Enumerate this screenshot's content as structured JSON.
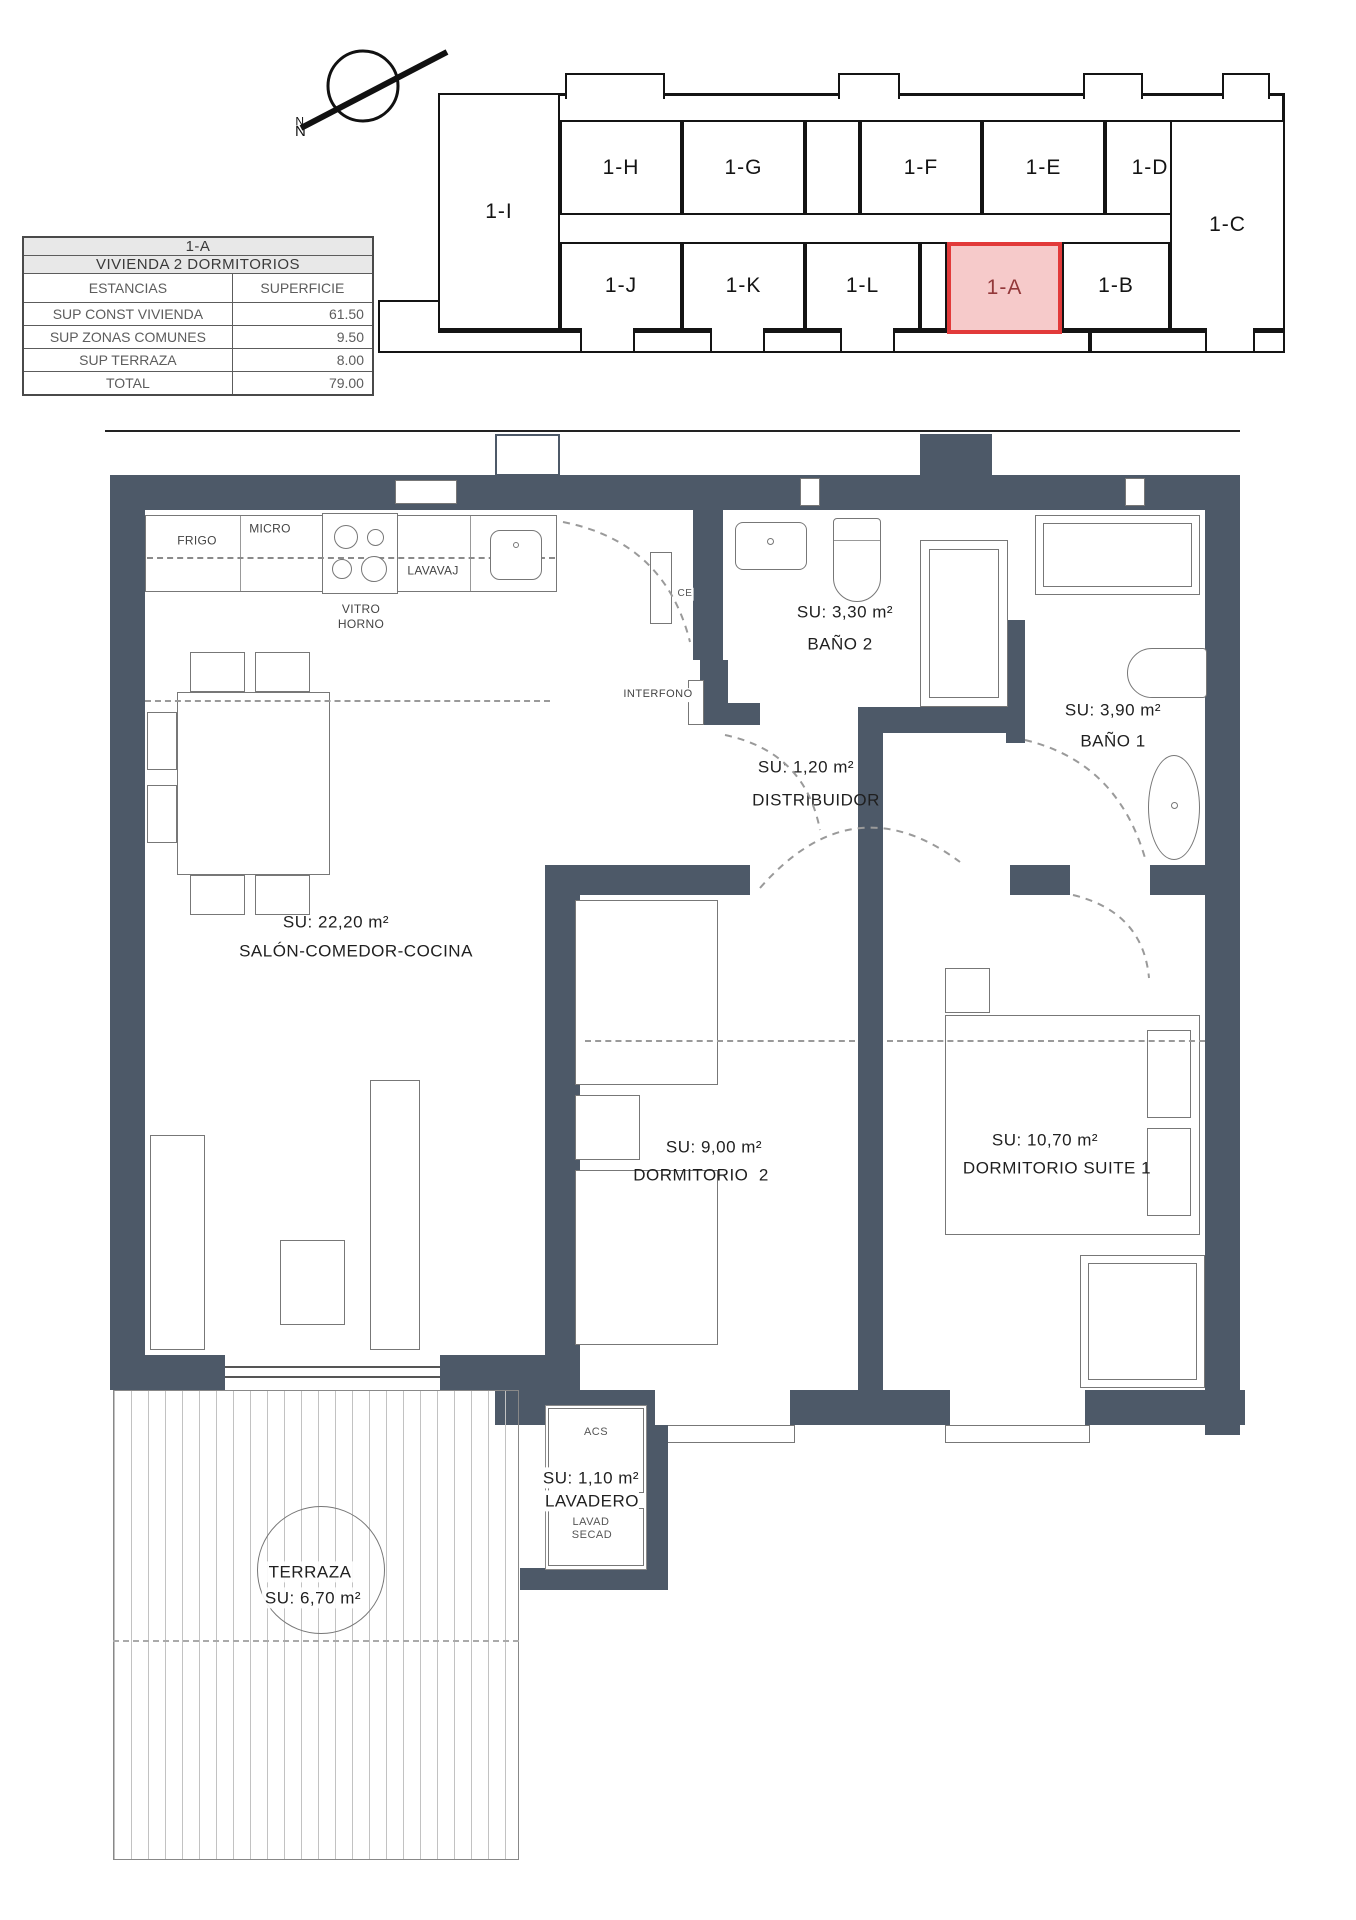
{
  "north": {
    "label": "N"
  },
  "key_plan": {
    "unit_left": "1-I",
    "unit_right": "1-C",
    "units_top": [
      "1-H",
      "1-G",
      "1-F",
      "1-E",
      "1-D"
    ],
    "units_bottom": [
      "1-J",
      "1-K",
      "1-L",
      "1-A",
      "1-B"
    ],
    "highlighted_unit": "1-A",
    "highlight_border": "#e23a3a",
    "highlight_fill": "#f6caca"
  },
  "info_table": {
    "title": "1-A",
    "subtitle": "VIVIENDA 2 DORMITORIOS",
    "col_estancias": "ESTANCIAS",
    "col_superficie": "SUPERFICIE",
    "rows": [
      {
        "label": "SUP CONST VIVIENDA",
        "value": "61.50"
      },
      {
        "label": "SUP ZONAS COMUNES",
        "value": "9.50"
      },
      {
        "label": "SUP TERRAZA",
        "value": "8.00"
      },
      {
        "label": "TOTAL",
        "value": "79.00"
      }
    ]
  },
  "plan": {
    "wall_color": "#4d5968",
    "rooms": {
      "salon": {
        "su": "SU: 22,20 m²",
        "name": "SALÓN-COMEDOR-COCINA"
      },
      "bano2": {
        "su": "SU: 3,30 m²",
        "name": "BAÑO 2"
      },
      "bano1": {
        "su": "SU: 3,90 m²",
        "name": "BAÑO 1"
      },
      "distribuidor": {
        "su": "SU: 1,20 m²",
        "name": "DISTRIBUIDOR"
      },
      "dormitorio2": {
        "su": "SU: 9,00 m²",
        "name": "DORMITORIO  2"
      },
      "suite": {
        "su": "SU: 10,70 m²",
        "name": "DORMITORIO SUITE 1"
      },
      "terraza": {
        "name": "TERRAZA",
        "su": "SU: 6,70 m²"
      },
      "lavadero": {
        "su": "SU: 1,10 m²",
        "name": "LAVADERO",
        "acs": "ACS",
        "lavad": "LAVAD",
        "secad": "SECAD"
      }
    },
    "kitchen": {
      "frigo": "FRIGO",
      "micro": "MICRO",
      "lavavaj": "LAVAVAJ",
      "vitro_horno": "VITRO\nHORNO"
    },
    "annotations": {
      "interfono": "INTERFONO",
      "ce": "CE"
    }
  }
}
